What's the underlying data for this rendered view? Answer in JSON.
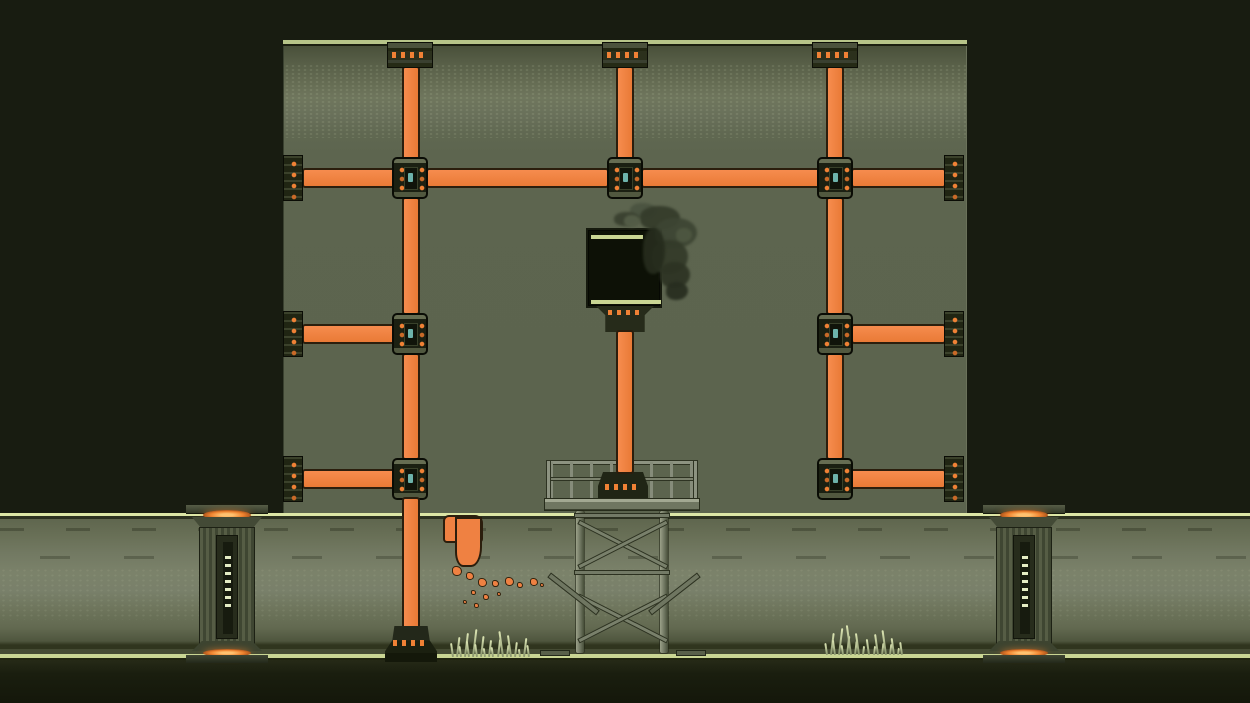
{
  "scene": {
    "kind": "2d-pixel-game-industrial-room",
    "colors": {
      "background_dark": "#181c11",
      "wall": "#5d654f",
      "wall_top_shade": "#49503a",
      "trim_light_line": "#c9d593",
      "pipe_orange": "#ef8142",
      "pipe_outline": "#2b1e0d",
      "ground_pipe_mid": "#7b826a",
      "metal_dark": "#202513",
      "metal_gray": "#59604a",
      "junction_light_teal": "#6db3ab",
      "pillar_glow_orange": "#ef832f",
      "smoke": "#39402f",
      "scaffold_gray": "#7d8371",
      "grass_light": "#dde6b4"
    },
    "wall_rect": {
      "x": 283,
      "y": 41,
      "w": 684,
      "h": 472
    },
    "pipe_segments": [
      {
        "x": 402,
        "y": 66,
        "w": 18,
        "h": 94
      },
      {
        "x": 616,
        "y": 66,
        "w": 18,
        "h": 94
      },
      {
        "x": 826,
        "y": 66,
        "w": 18,
        "h": 94
      },
      {
        "x": 402,
        "y": 197,
        "w": 18,
        "h": 118
      },
      {
        "x": 826,
        "y": 197,
        "w": 18,
        "h": 118
      },
      {
        "x": 402,
        "y": 353,
        "w": 18,
        "h": 107
      },
      {
        "x": 826,
        "y": 353,
        "w": 18,
        "h": 107
      },
      {
        "x": 302,
        "y": 168,
        "w": 94,
        "h": 20
      },
      {
        "x": 426,
        "y": 168,
        "w": 183,
        "h": 20
      },
      {
        "x": 641,
        "y": 168,
        "w": 179,
        "h": 20
      },
      {
        "x": 851,
        "y": 168,
        "w": 95,
        "h": 20
      },
      {
        "x": 302,
        "y": 324,
        "w": 94,
        "h": 20
      },
      {
        "x": 851,
        "y": 324,
        "w": 95,
        "h": 20
      },
      {
        "x": 302,
        "y": 469,
        "w": 94,
        "h": 20
      },
      {
        "x": 849,
        "y": 469,
        "w": 97,
        "h": 20
      },
      {
        "x": 402,
        "y": 497,
        "w": 18,
        "h": 133,
        "front": true
      },
      {
        "x": 616,
        "y": 330,
        "w": 18,
        "h": 144,
        "front": true
      }
    ],
    "junctions": [
      {
        "x": 410,
        "y": 178,
        "kind": "cross"
      },
      {
        "x": 625,
        "y": 178,
        "kind": "cross"
      },
      {
        "x": 835,
        "y": 178,
        "kind": "cross"
      },
      {
        "x": 410,
        "y": 334,
        "kind": "tee"
      },
      {
        "x": 835,
        "y": 334,
        "kind": "tee"
      },
      {
        "x": 410,
        "y": 479,
        "kind": "tee"
      },
      {
        "x": 835,
        "y": 479,
        "kind": "elbow"
      }
    ],
    "flanges": [
      {
        "x": 283,
        "y": 178,
        "side": "left"
      },
      {
        "x": 283,
        "y": 334,
        "side": "left"
      },
      {
        "x": 283,
        "y": 479,
        "side": "left"
      },
      {
        "x": 944,
        "y": 178,
        "side": "right"
      },
      {
        "x": 944,
        "y": 334,
        "side": "right"
      },
      {
        "x": 944,
        "y": 479,
        "side": "right"
      }
    ],
    "ceiling_mounts": [
      {
        "x": 410
      },
      {
        "x": 625
      },
      {
        "x": 835
      }
    ],
    "smoke_blobs": [
      {
        "x": 630,
        "y": 203,
        "w": 26,
        "h": 16,
        "c": "#4a5340"
      },
      {
        "x": 614,
        "y": 212,
        "w": 26,
        "h": 14,
        "c": "#39402f"
      },
      {
        "x": 640,
        "y": 206,
        "w": 40,
        "h": 24,
        "c": "#343b2a"
      },
      {
        "x": 655,
        "y": 218,
        "w": 42,
        "h": 30,
        "c": "#3d4533"
      },
      {
        "x": 652,
        "y": 240,
        "w": 36,
        "h": 34,
        "c": "#333a29"
      },
      {
        "x": 660,
        "y": 262,
        "w": 30,
        "h": 26,
        "c": "#2d3323"
      },
      {
        "x": 666,
        "y": 282,
        "w": 22,
        "h": 18,
        "c": "#272d1f"
      },
      {
        "x": 643,
        "y": 228,
        "w": 22,
        "h": 46,
        "c": "#262c1d"
      },
      {
        "x": 624,
        "y": 215,
        "w": 16,
        "h": 12,
        "c": "#555e48"
      },
      {
        "x": 676,
        "y": 228,
        "w": 16,
        "h": 14,
        "c": "#4e5741"
      }
    ],
    "grass_tufts": [
      {
        "x": 452,
        "y": 657,
        "blades": [
          [
            0,
            14
          ],
          [
            4,
            20
          ],
          [
            8,
            11
          ],
          [
            12,
            24
          ],
          [
            16,
            16
          ],
          [
            20,
            28
          ],
          [
            24,
            13
          ],
          [
            28,
            21
          ],
          [
            32,
            9
          ],
          [
            36,
            17
          ]
        ]
      },
      {
        "x": 492,
        "y": 657,
        "blades": [
          [
            0,
            10
          ],
          [
            5,
            18
          ],
          [
            10,
            26
          ],
          [
            14,
            12
          ],
          [
            18,
            22
          ],
          [
            22,
            15
          ],
          [
            27,
            8
          ],
          [
            31,
            19
          ],
          [
            36,
            12
          ]
        ]
      },
      {
        "x": 826,
        "y": 655,
        "blades": [
          [
            0,
            12
          ],
          [
            4,
            22
          ],
          [
            8,
            15
          ],
          [
            12,
            27
          ],
          [
            16,
            10
          ],
          [
            20,
            19
          ],
          [
            24,
            30
          ],
          [
            28,
            14
          ],
          [
            32,
            22
          ],
          [
            36,
            9
          ]
        ]
      },
      {
        "x": 868,
        "y": 655,
        "blades": [
          [
            0,
            16
          ],
          [
            5,
            9
          ],
          [
            9,
            21
          ],
          [
            13,
            12
          ],
          [
            17,
            25
          ],
          [
            21,
            11
          ],
          [
            25,
            17
          ],
          [
            29,
            7
          ],
          [
            33,
            13
          ]
        ]
      }
    ],
    "spill_dots": [
      {
        "x": 452,
        "y": 566,
        "s": 10
      },
      {
        "x": 466,
        "y": 572,
        "s": 8
      },
      {
        "x": 478,
        "y": 578,
        "s": 9
      },
      {
        "x": 492,
        "y": 580,
        "s": 7
      },
      {
        "x": 505,
        "y": 577,
        "s": 9
      },
      {
        "x": 517,
        "y": 582,
        "s": 6
      },
      {
        "x": 530,
        "y": 578,
        "s": 8
      },
      {
        "x": 540,
        "y": 583,
        "s": 4
      },
      {
        "x": 471,
        "y": 590,
        "s": 5
      },
      {
        "x": 483,
        "y": 594,
        "s": 6
      },
      {
        "x": 497,
        "y": 592,
        "s": 4
      },
      {
        "x": 463,
        "y": 600,
        "s": 4
      },
      {
        "x": 474,
        "y": 603,
        "s": 5
      }
    ]
  }
}
